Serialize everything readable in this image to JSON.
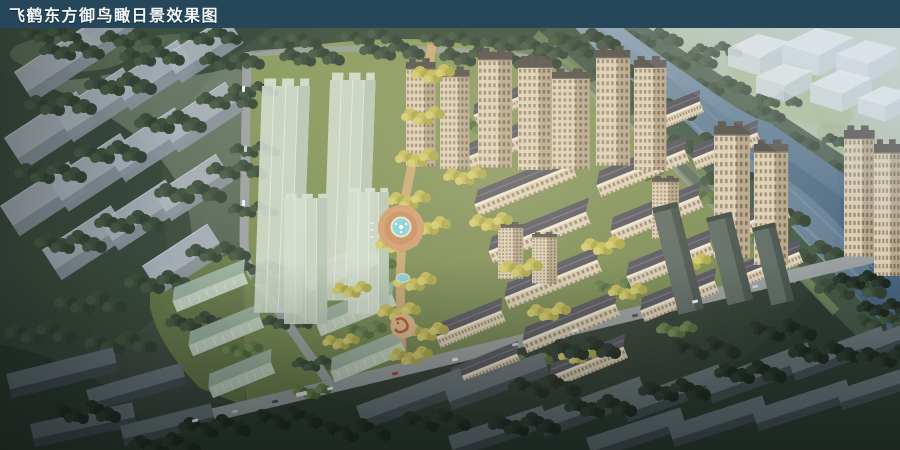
{
  "header": {
    "title": "飞鹤东方御鸟瞰日景效果图",
    "bar_style": "background:#26475A;color:#F2F6F8",
    "bg_color": "#26475A",
    "text_color": "#F2F6F8"
  },
  "scene": {
    "palette": {
      "river": "#5D7A93",
      "river_light": "#8BA1B1",
      "far_bank_field": "#9CAE87",
      "riverbank_tree": "#445A4A",
      "tree_dark": "#3C4E40",
      "tree_deep": "#2F3C33",
      "tree_yellow": "#C5BC5C",
      "tree_green": "#5E7948",
      "lawn": "#84965A",
      "building_tan": "#DBCFB7",
      "building_roof": "#54545E",
      "glass_green": "#CFDCCF",
      "context_roof": "#AAB2BC",
      "context_front": "#8B949E",
      "dark_roof": "#6A757C",
      "dark_front": "#454F55",
      "road": "#9AA0A2",
      "axis_paving": "#CFA878",
      "plaza_paving": "#D09A6C",
      "pool_water": "#7FD0DC",
      "feature_red": "#BF4F2A",
      "massing_white": "#E7ECF1"
    }
  }
}
